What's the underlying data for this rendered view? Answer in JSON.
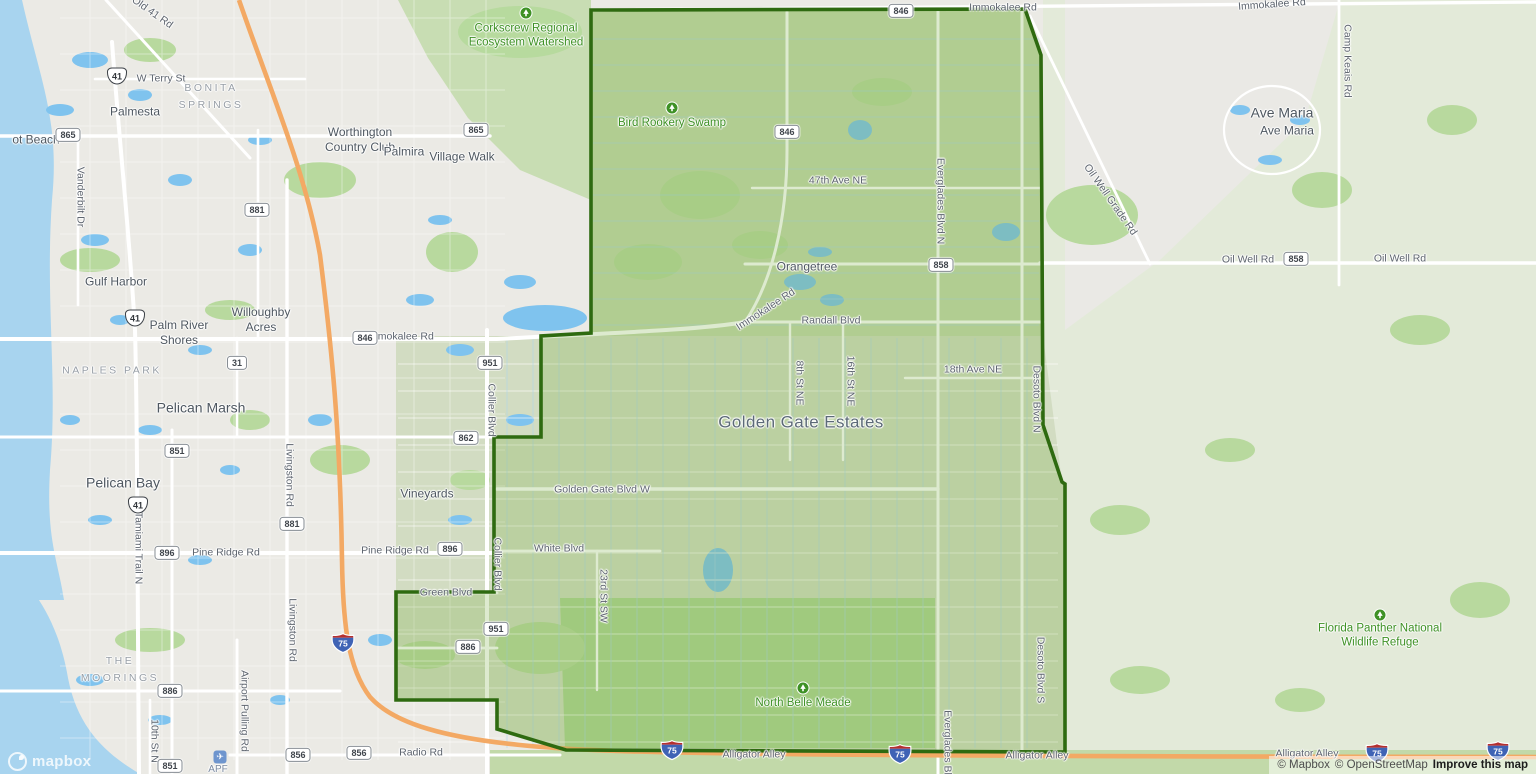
{
  "map": {
    "colors": {
      "boundary_stroke": "#2e6a10",
      "boundary_fill": "rgba(118,170,62,0.25)",
      "water": "#a8d4ef",
      "motorway_orange": "#f3a964",
      "poi_green": "#3e9125",
      "interstate_blue": "#3f63b5",
      "interstate_red": "#b5302f"
    },
    "region": {
      "name": "Golden Gate Estates",
      "points": [
        [
          591,
          10
        ],
        [
          1025,
          9
        ],
        [
          1041,
          55
        ],
        [
          1043,
          425
        ],
        [
          1062,
          482
        ],
        [
          1065,
          484
        ],
        [
          1065,
          752
        ],
        [
          566,
          750
        ],
        [
          497,
          729
        ],
        [
          497,
          700
        ],
        [
          396,
          700
        ],
        [
          396,
          592
        ],
        [
          494,
          592
        ],
        [
          494,
          437
        ],
        [
          541,
          437
        ],
        [
          541,
          336
        ],
        [
          591,
          333
        ]
      ]
    },
    "place_labels": [
      {
        "t": "Palmesta",
        "x": 135,
        "y": 112,
        "cls": "place"
      },
      {
        "t": "BONITA\nSPRINGS",
        "x": 211,
        "y": 97,
        "cls": "caps"
      },
      {
        "t": "ot Beach",
        "x": 36,
        "y": 140,
        "cls": "place"
      },
      {
        "t": "Gulf Harbor",
        "x": 116,
        "y": 282,
        "cls": "place"
      },
      {
        "t": "Palm River\nShores",
        "x": 179,
        "y": 333,
        "cls": "place"
      },
      {
        "t": "Willoughby\nAcres",
        "x": 261,
        "y": 320,
        "cls": "place"
      },
      {
        "t": "NAPLES PARK",
        "x": 112,
        "y": 371,
        "cls": "caps"
      },
      {
        "t": "Pelican Marsh",
        "x": 201,
        "y": 408,
        "cls": "place place-lg"
      },
      {
        "t": "Pelican Bay",
        "x": 123,
        "y": 483,
        "cls": "place place-lg"
      },
      {
        "t": "THE\nMOORINGS",
        "x": 120,
        "y": 670,
        "cls": "caps"
      },
      {
        "t": "Worthington\nCountry Club",
        "x": 360,
        "y": 140,
        "cls": "place"
      },
      {
        "t": "Palmira",
        "x": 404,
        "y": 152,
        "cls": "place"
      },
      {
        "t": "Village Walk",
        "x": 462,
        "y": 157,
        "cls": "place"
      },
      {
        "t": "Vineyards",
        "x": 427,
        "y": 494,
        "cls": "place"
      },
      {
        "t": "Orangetree",
        "x": 807,
        "y": 267,
        "cls": "place"
      },
      {
        "t": "Golden Gate Estates",
        "x": 801,
        "y": 422,
        "cls": "area"
      },
      {
        "t": "Ave Maria",
        "x": 1282,
        "y": 113,
        "cls": "place place-lg"
      },
      {
        "t": "Ave Maria",
        "x": 1287,
        "y": 131,
        "cls": "place"
      }
    ],
    "road_labels": [
      {
        "t": "Old 41 Rd",
        "x": 152,
        "y": 13,
        "r": 35
      },
      {
        "t": "W Terry St",
        "x": 161,
        "y": 79
      },
      {
        "t": "Vanderbilt Dr",
        "x": 80,
        "y": 197,
        "r": 90
      },
      {
        "t": "Immokalee Rd",
        "x": 400,
        "y": 337
      },
      {
        "t": "Immokalee Rd",
        "x": 766,
        "y": 310,
        "r": -33
      },
      {
        "t": "Immokalee Rd",
        "x": 1003,
        "y": 8
      },
      {
        "t": "Immokalee Rd",
        "x": 1272,
        "y": 5,
        "r": -4
      },
      {
        "t": "Randall Blvd",
        "x": 831,
        "y": 321
      },
      {
        "t": "47th Ave NE",
        "x": 838,
        "y": 181
      },
      {
        "t": "18th Ave NE",
        "x": 973,
        "y": 370
      },
      {
        "t": "8th St NE",
        "x": 799,
        "y": 383,
        "r": 90
      },
      {
        "t": "16th St NE",
        "x": 850,
        "y": 381,
        "r": 90
      },
      {
        "t": "Everglades Blvd N",
        "x": 940,
        "y": 201,
        "r": 90
      },
      {
        "t": "Everglades Blvd",
        "x": 947,
        "y": 748,
        "r": 90
      },
      {
        "t": "Desoto Blvd N",
        "x": 1036,
        "y": 399,
        "r": 90
      },
      {
        "t": "Desoto Blvd S",
        "x": 1040,
        "y": 670,
        "r": 90
      },
      {
        "t": "Camp Keais Rd",
        "x": 1347,
        "y": 61,
        "r": 90
      },
      {
        "t": "Oil Well Grade Rd",
        "x": 1110,
        "y": 200,
        "r": 55
      },
      {
        "t": "Oil Well Rd",
        "x": 1248,
        "y": 260
      },
      {
        "t": "Oil Well Rd",
        "x": 1400,
        "y": 259
      },
      {
        "t": "Collier Blvd",
        "x": 491,
        "y": 410,
        "r": 90
      },
      {
        "t": "Collier Blvd",
        "x": 497,
        "y": 564,
        "r": 90
      },
      {
        "t": "Golden Gate Blvd W",
        "x": 602,
        "y": 490
      },
      {
        "t": "White Blvd",
        "x": 559,
        "y": 549
      },
      {
        "t": "23rd St SW",
        "x": 603,
        "y": 596,
        "r": 90
      },
      {
        "t": "Green Blvd",
        "x": 446,
        "y": 593
      },
      {
        "t": "Pine Ridge Rd",
        "x": 226,
        "y": 553
      },
      {
        "t": "Pine Ridge Rd",
        "x": 395,
        "y": 551
      },
      {
        "t": "Livingston Rd",
        "x": 289,
        "y": 475,
        "r": 90
      },
      {
        "t": "Livingston Rd",
        "x": 292,
        "y": 630,
        "r": 90
      },
      {
        "t": "Tamiami Trail N",
        "x": 138,
        "y": 548,
        "r": 90
      },
      {
        "t": "10th St N",
        "x": 154,
        "y": 741,
        "r": 90
      },
      {
        "t": "Airport Pulling Rd",
        "x": 244,
        "y": 711,
        "r": 90
      },
      {
        "t": "Radio Rd",
        "x": 421,
        "y": 753
      },
      {
        "t": "Alligator Alley",
        "x": 754,
        "y": 755
      },
      {
        "t": "Alligator Alley",
        "x": 1037,
        "y": 756
      },
      {
        "t": "Alligator Alley",
        "x": 1307,
        "y": 754
      }
    ],
    "poi_labels": [
      {
        "t": "Corkscrew Regional\nEcosystem Watershed",
        "x": 526,
        "y": 36,
        "icon": "park-icon",
        "icon_dy": -23
      },
      {
        "t": "Bird Rookery Swamp",
        "x": 672,
        "y": 123,
        "icon": "park-icon",
        "icon_dy": -15
      },
      {
        "t": "North Belle Meade",
        "x": 803,
        "y": 703,
        "icon": "park-icon",
        "icon_dy": -15
      },
      {
        "t": "Florida Panther National\nWildlife Refuge",
        "x": 1380,
        "y": 636,
        "icon": "park-icon",
        "icon_dy": -21
      }
    ],
    "shields": [
      {
        "kind": "box",
        "label": "865",
        "x": 68,
        "y": 135
      },
      {
        "kind": "box",
        "label": "865",
        "x": 476,
        "y": 130
      },
      {
        "kind": "box",
        "label": "881",
        "x": 257,
        "y": 210
      },
      {
        "kind": "box",
        "label": "846",
        "x": 365,
        "y": 338
      },
      {
        "kind": "box",
        "label": "846",
        "x": 787,
        "y": 132
      },
      {
        "kind": "box",
        "label": "846",
        "x": 901,
        "y": 11
      },
      {
        "kind": "box",
        "label": "858",
        "x": 941,
        "y": 265
      },
      {
        "kind": "box",
        "label": "858",
        "x": 1296,
        "y": 259
      },
      {
        "kind": "box",
        "label": "31",
        "x": 237,
        "y": 363
      },
      {
        "kind": "box",
        "label": "951",
        "x": 490,
        "y": 363
      },
      {
        "kind": "box",
        "label": "862",
        "x": 466,
        "y": 438
      },
      {
        "kind": "box",
        "label": "881",
        "x": 292,
        "y": 524
      },
      {
        "kind": "box",
        "label": "896",
        "x": 167,
        "y": 553
      },
      {
        "kind": "box",
        "label": "896",
        "x": 450,
        "y": 549
      },
      {
        "kind": "box",
        "label": "951",
        "x": 496,
        "y": 629
      },
      {
        "kind": "box",
        "label": "886",
        "x": 468,
        "y": 647
      },
      {
        "kind": "box",
        "label": "886",
        "x": 170,
        "y": 691
      },
      {
        "kind": "box",
        "label": "851",
        "x": 177,
        "y": 451
      },
      {
        "kind": "box",
        "label": "851",
        "x": 170,
        "y": 766
      },
      {
        "kind": "box",
        "label": "856",
        "x": 298,
        "y": 755
      },
      {
        "kind": "box",
        "label": "856",
        "x": 359,
        "y": 753
      },
      {
        "kind": "us",
        "label": "41",
        "x": 117,
        "y": 76
      },
      {
        "kind": "us",
        "label": "41",
        "x": 135,
        "y": 318
      },
      {
        "kind": "us",
        "label": "41",
        "x": 138,
        "y": 505
      },
      {
        "kind": "i75",
        "label": "75",
        "x": 343,
        "y": 643
      },
      {
        "kind": "i75",
        "label": "75",
        "x": 672,
        "y": 750
      },
      {
        "kind": "i75",
        "label": "75",
        "x": 900,
        "y": 754
      },
      {
        "kind": "i75",
        "label": "75",
        "x": 1377,
        "y": 753
      },
      {
        "kind": "i75",
        "label": "75",
        "x": 1498,
        "y": 751
      }
    ],
    "airport": {
      "icon": "airplane-icon",
      "glyph": "✈",
      "code": "APF",
      "x": 220,
      "y": 757
    },
    "logo_text": "mapbox",
    "attribution": {
      "mapbox": "© Mapbox",
      "osm": "© OpenStreetMap",
      "improve": "Improve this map"
    }
  }
}
